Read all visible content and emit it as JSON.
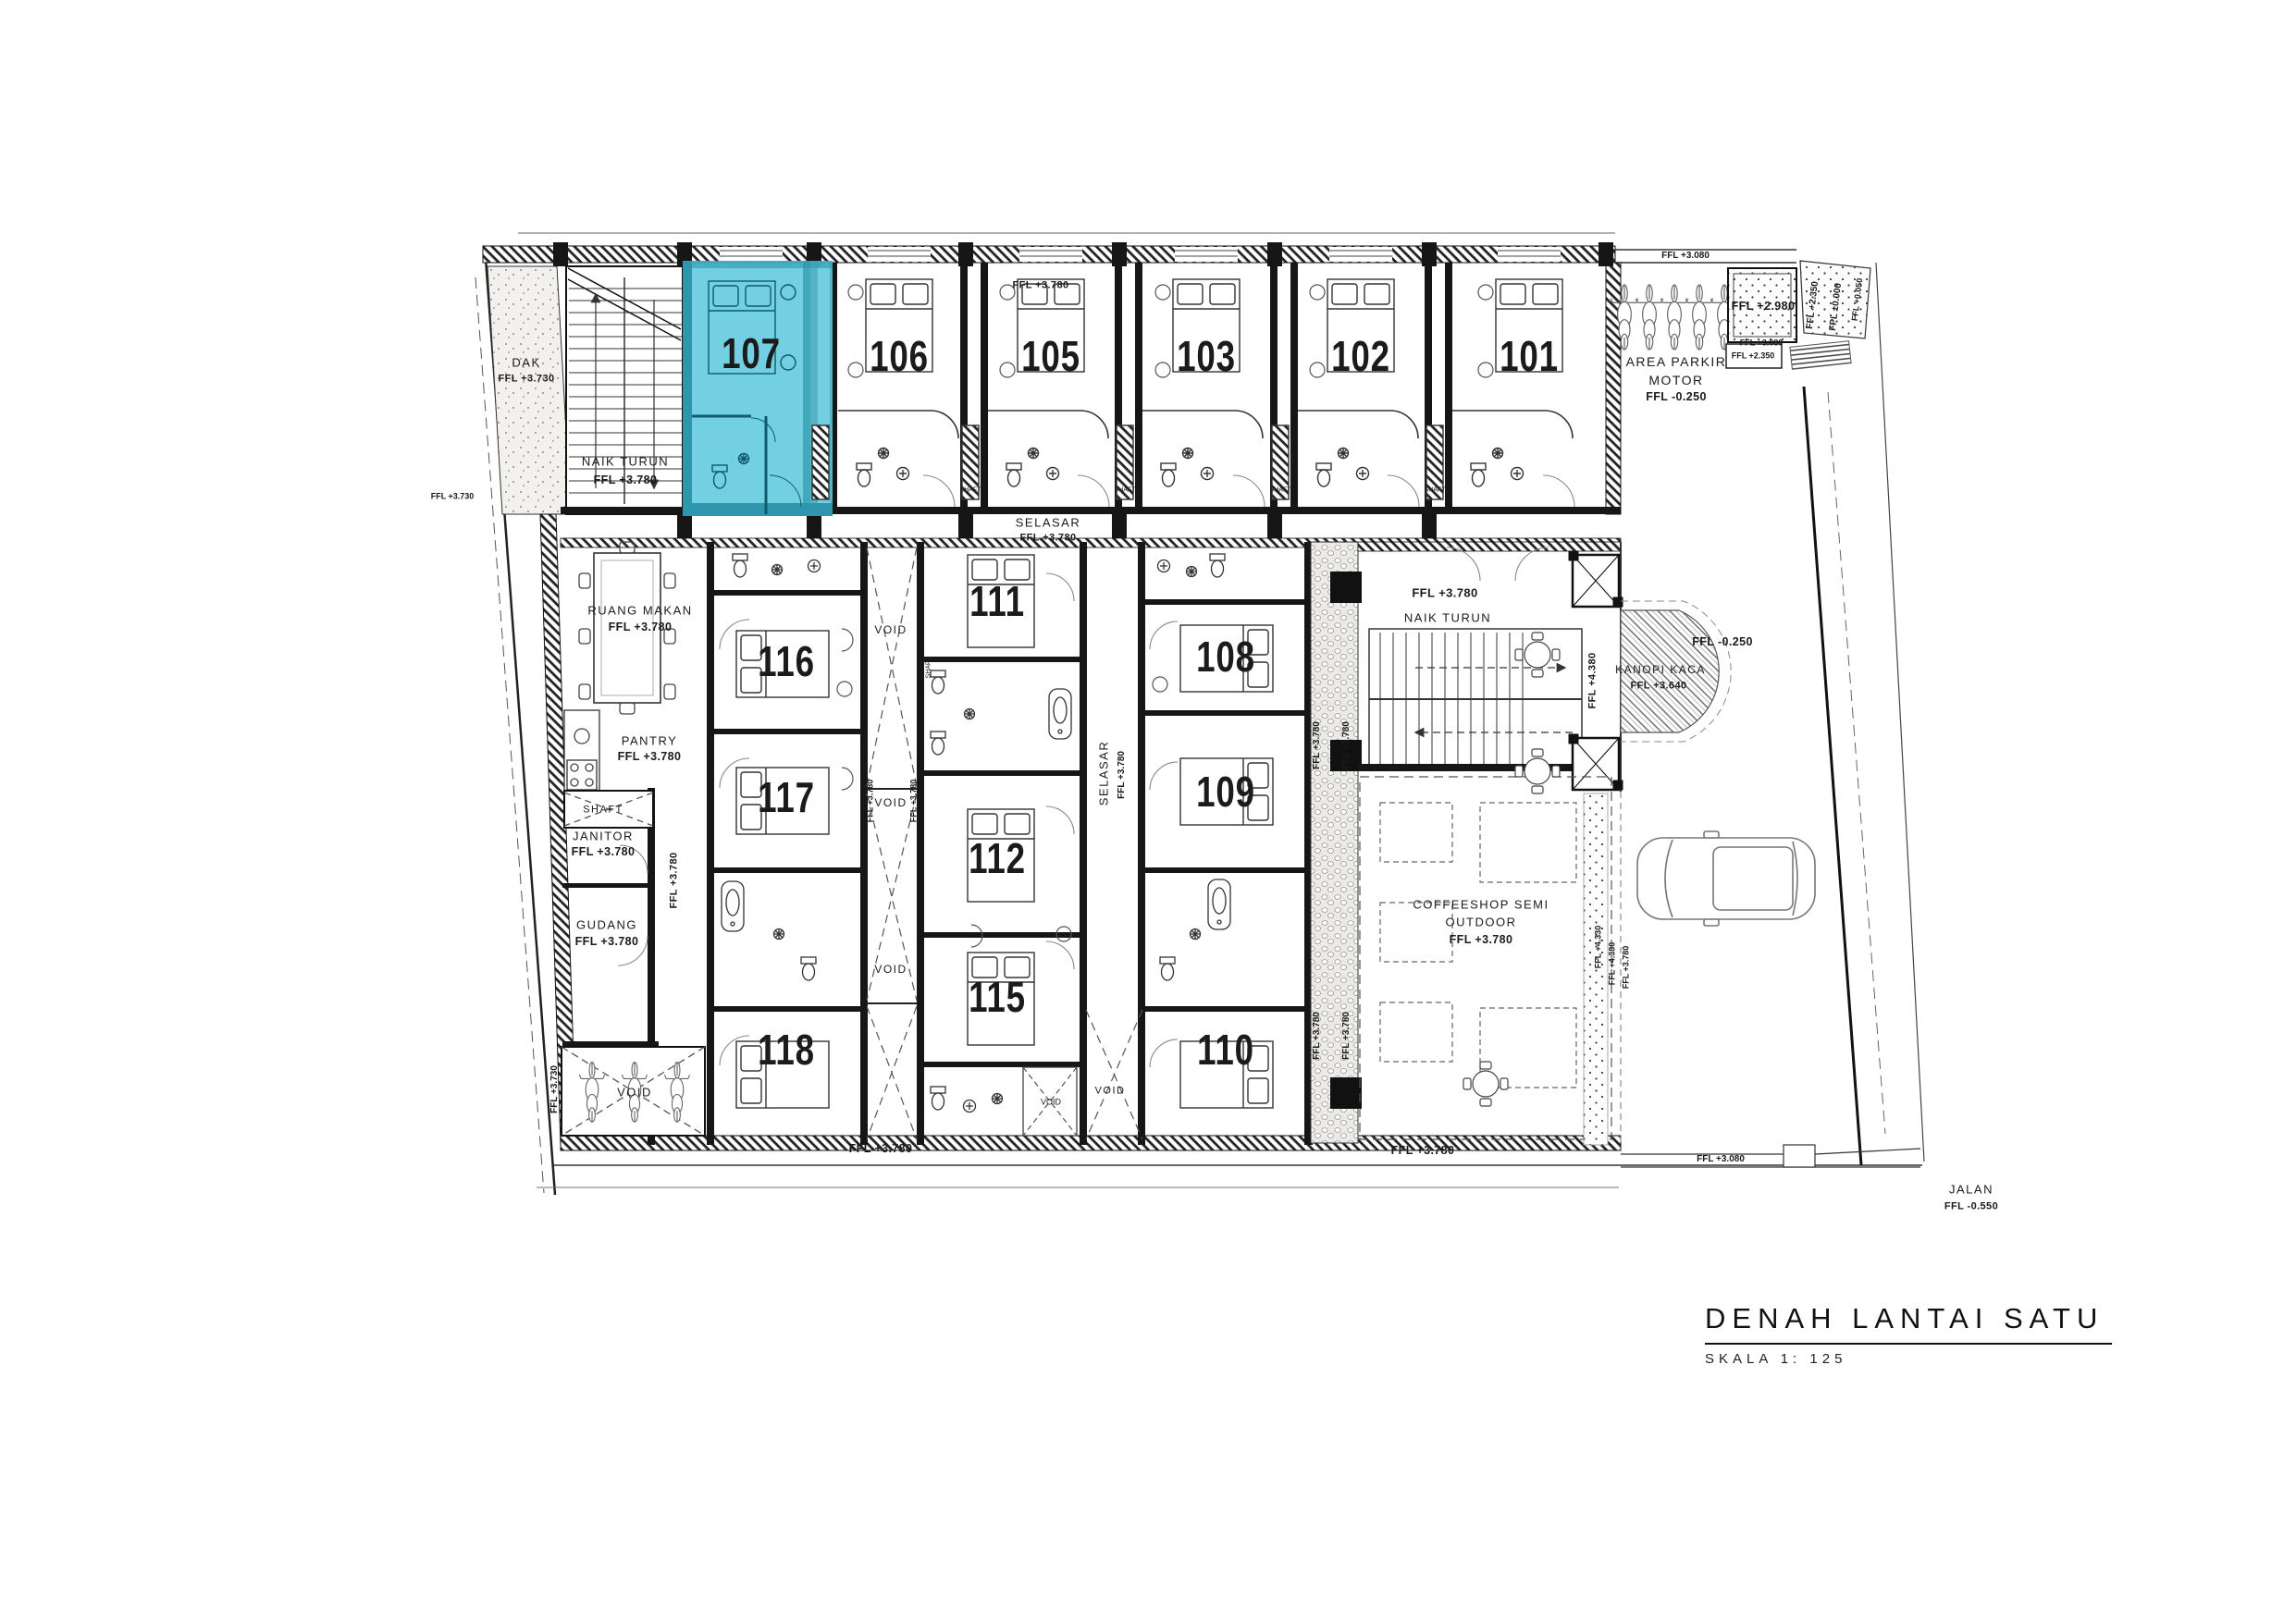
{
  "title": {
    "main": "DENAH LANTAI SATU",
    "scale": "SKALA 1: 125"
  },
  "rooms": {
    "r101": "101",
    "r102": "102",
    "r103": "103",
    "r105": "105",
    "r106": "106",
    "r107": "107",
    "r108": "108",
    "r109": "109",
    "r110": "110",
    "r111": "111",
    "r112": "112",
    "r115": "115",
    "r116": "116",
    "r117": "117",
    "r118": "118"
  },
  "areas": {
    "dak": "DAK",
    "naik_turun": "NAIK TURUN",
    "selasar": "SELASAR",
    "ruang_makan": "RUANG MAKAN",
    "pantry": "PANTRY",
    "shaft": "SHAFT",
    "janitor": "JANITOR",
    "gudang": "GUDANG",
    "void": "VOID",
    "coffeeshop_line1": "COFFEESHOP SEMI",
    "coffeeshop_line2": "OUTDOOR",
    "area_parkir_line1": "AREA PARKIR",
    "area_parkir_line2": "MOTOR",
    "kanopi_kaca": "KANOPI KACA",
    "jalan": "JALAN"
  },
  "levels": {
    "ffl_3780": "FFL +3.780",
    "ffl_3730": "FFL +3.730",
    "ffl_3080": "FFL +3.080",
    "ffl_2980": "FFL +2.980",
    "ffl_2350": "FFL +2.350",
    "fpl_0000": "FPL ±0.000",
    "ffl_0050": "FFL +0.050",
    "ffl_m0250": "FFL -0.250",
    "ffl_m0550": "FFL -0.550",
    "ffl_3640": "FFL +3.640",
    "ffl_4380": "FFL +4.380",
    "ffl_4330": "FFL +4.330"
  },
  "highlight": {
    "room": "107",
    "fill": "#5fc9de"
  }
}
